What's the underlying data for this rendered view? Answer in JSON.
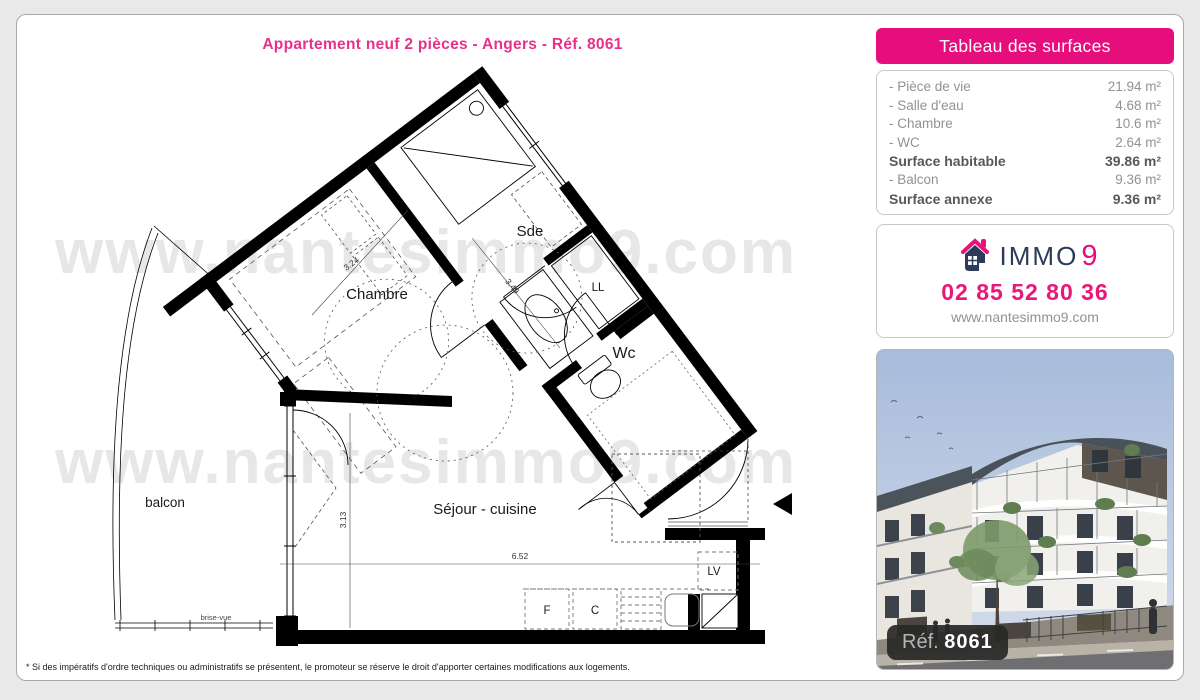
{
  "page": {
    "title": "Appartement neuf 2 pièces - Angers - Réf. 8061",
    "disclaimer": "* Si des impératifs d'ordre techniques ou administratifs se présentent, le promoteur se réserve le droit d'apporter certaines modifications aux logements."
  },
  "floor_plan": {
    "watermark_line1": "www.nantesimmo9.com",
    "watermark_line2": "www.nantesimmo9.com",
    "labels": {
      "sde": "Sde",
      "chambre": "Chambre",
      "wc": "Wc",
      "ll": "LL",
      "lv": "LV",
      "fridge": "F",
      "cooking": "C",
      "balcony": "balcon",
      "living": "Séjour - cuisine",
      "brise_vue": "brise-vue"
    },
    "dimensions": {
      "chambre_width": "3.24",
      "chambre_depth": "3.49",
      "living_height": "3.13",
      "living_width": "6.52"
    }
  },
  "surfaces": {
    "header": "Tableau des surfaces",
    "rows": [
      {
        "label": "- Pièce de vie",
        "value": "21.94 m²",
        "bold": false
      },
      {
        "label": "- Salle d'eau",
        "value": "4.68 m²",
        "bold": false
      },
      {
        "label": "- Chambre",
        "value": "10.6 m²",
        "bold": false
      },
      {
        "label": "- WC",
        "value": "2.64 m²",
        "bold": false
      },
      {
        "label": "Surface habitable",
        "value": "39.86 m²",
        "bold": true
      },
      {
        "label": "- Balcon",
        "value": "9.36 m²",
        "bold": false
      },
      {
        "label": "Surface annexe",
        "value": "9.36 m²",
        "bold": true
      }
    ]
  },
  "contact": {
    "brand_immo": "IMMO",
    "brand_9": "9",
    "phone": "02 85 52 80 36",
    "website": "www.nantesimmo9.com"
  },
  "photo": {
    "ref_label": "Réf.",
    "ref_number": "8061"
  },
  "colors": {
    "accent_pink": "#e60d7d",
    "navy": "#2b3b58",
    "text_gray": "#8f9396",
    "watermark": "#e7e7e7"
  }
}
